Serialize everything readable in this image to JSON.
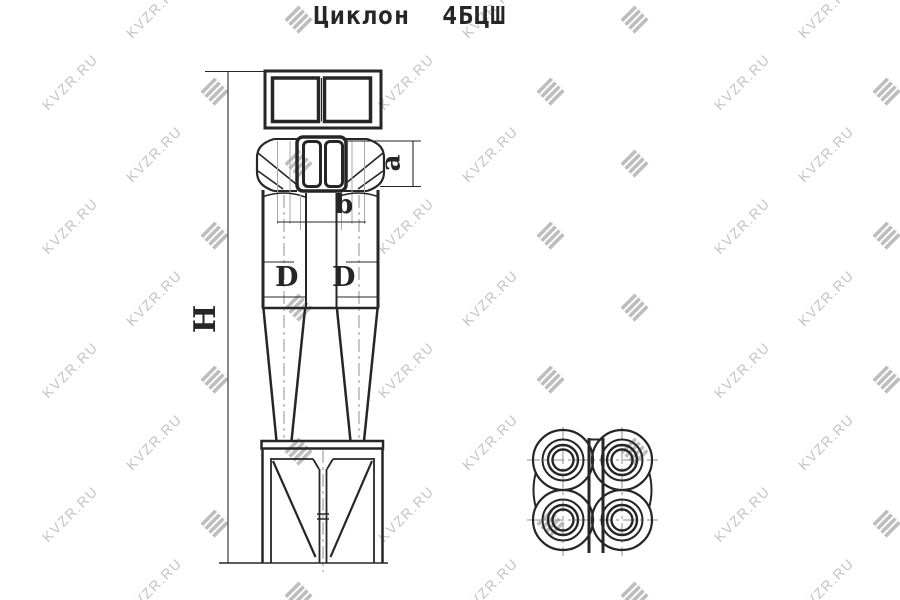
{
  "title": "Циклон  4БЦШ",
  "dimension_labels": {
    "overall_height": "H",
    "cyclone_diameter_left": "D",
    "cyclone_diameter_right": "D",
    "inlet_height": "a",
    "outlet_pipe_width": "b"
  },
  "watermark": {
    "text": "KVZR.RU",
    "logo_glyph": "≣"
  },
  "colors": {
    "background": "#ffffff",
    "line": "#262626",
    "centerline": "#8f8f8f",
    "hidden_line": "#a9a9a9",
    "watermark_text": "#c4c4c4",
    "watermark_logo": "#bdbdbd"
  }
}
